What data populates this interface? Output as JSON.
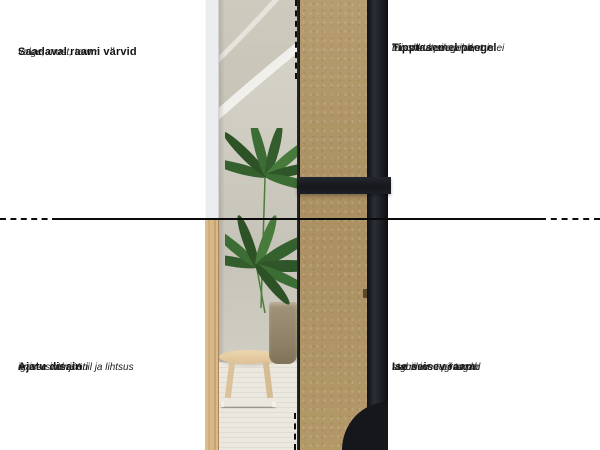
{
  "figure": {
    "kind": "product-feature-infographic",
    "subject": "full-length standing mirror, front lifestyle view and back construction view"
  },
  "annotations": {
    "top_left": {
      "title": "Saadaval raami värvid",
      "desc": [
        "valge, must, tamm"
      ]
    },
    "top_right": {
      "title": "Tipptasemel peegel",
      "desc": [
        "täiuslikult sile pind, mis ei",
        "moonuta peegeldust"
      ]
    },
    "bottom_left": {
      "title": "Ajatu disain",
      "desc": [
        "universaalne stiil ja lihtsus",
        "igasse interjööri"
      ]
    },
    "bottom_right": {
      "title": "Ise seisev raam",
      "desc": [
        "tagumine tugi tagab",
        "stabiilsuse põrandal"
      ]
    }
  },
  "colors": {
    "annotation_line": "#0d0d0d",
    "text": "#111111",
    "mdf_board": "#b1976a",
    "frame_black": "#16191d",
    "oak_frame": "#d8b886",
    "white_frame": "#ecedef"
  }
}
